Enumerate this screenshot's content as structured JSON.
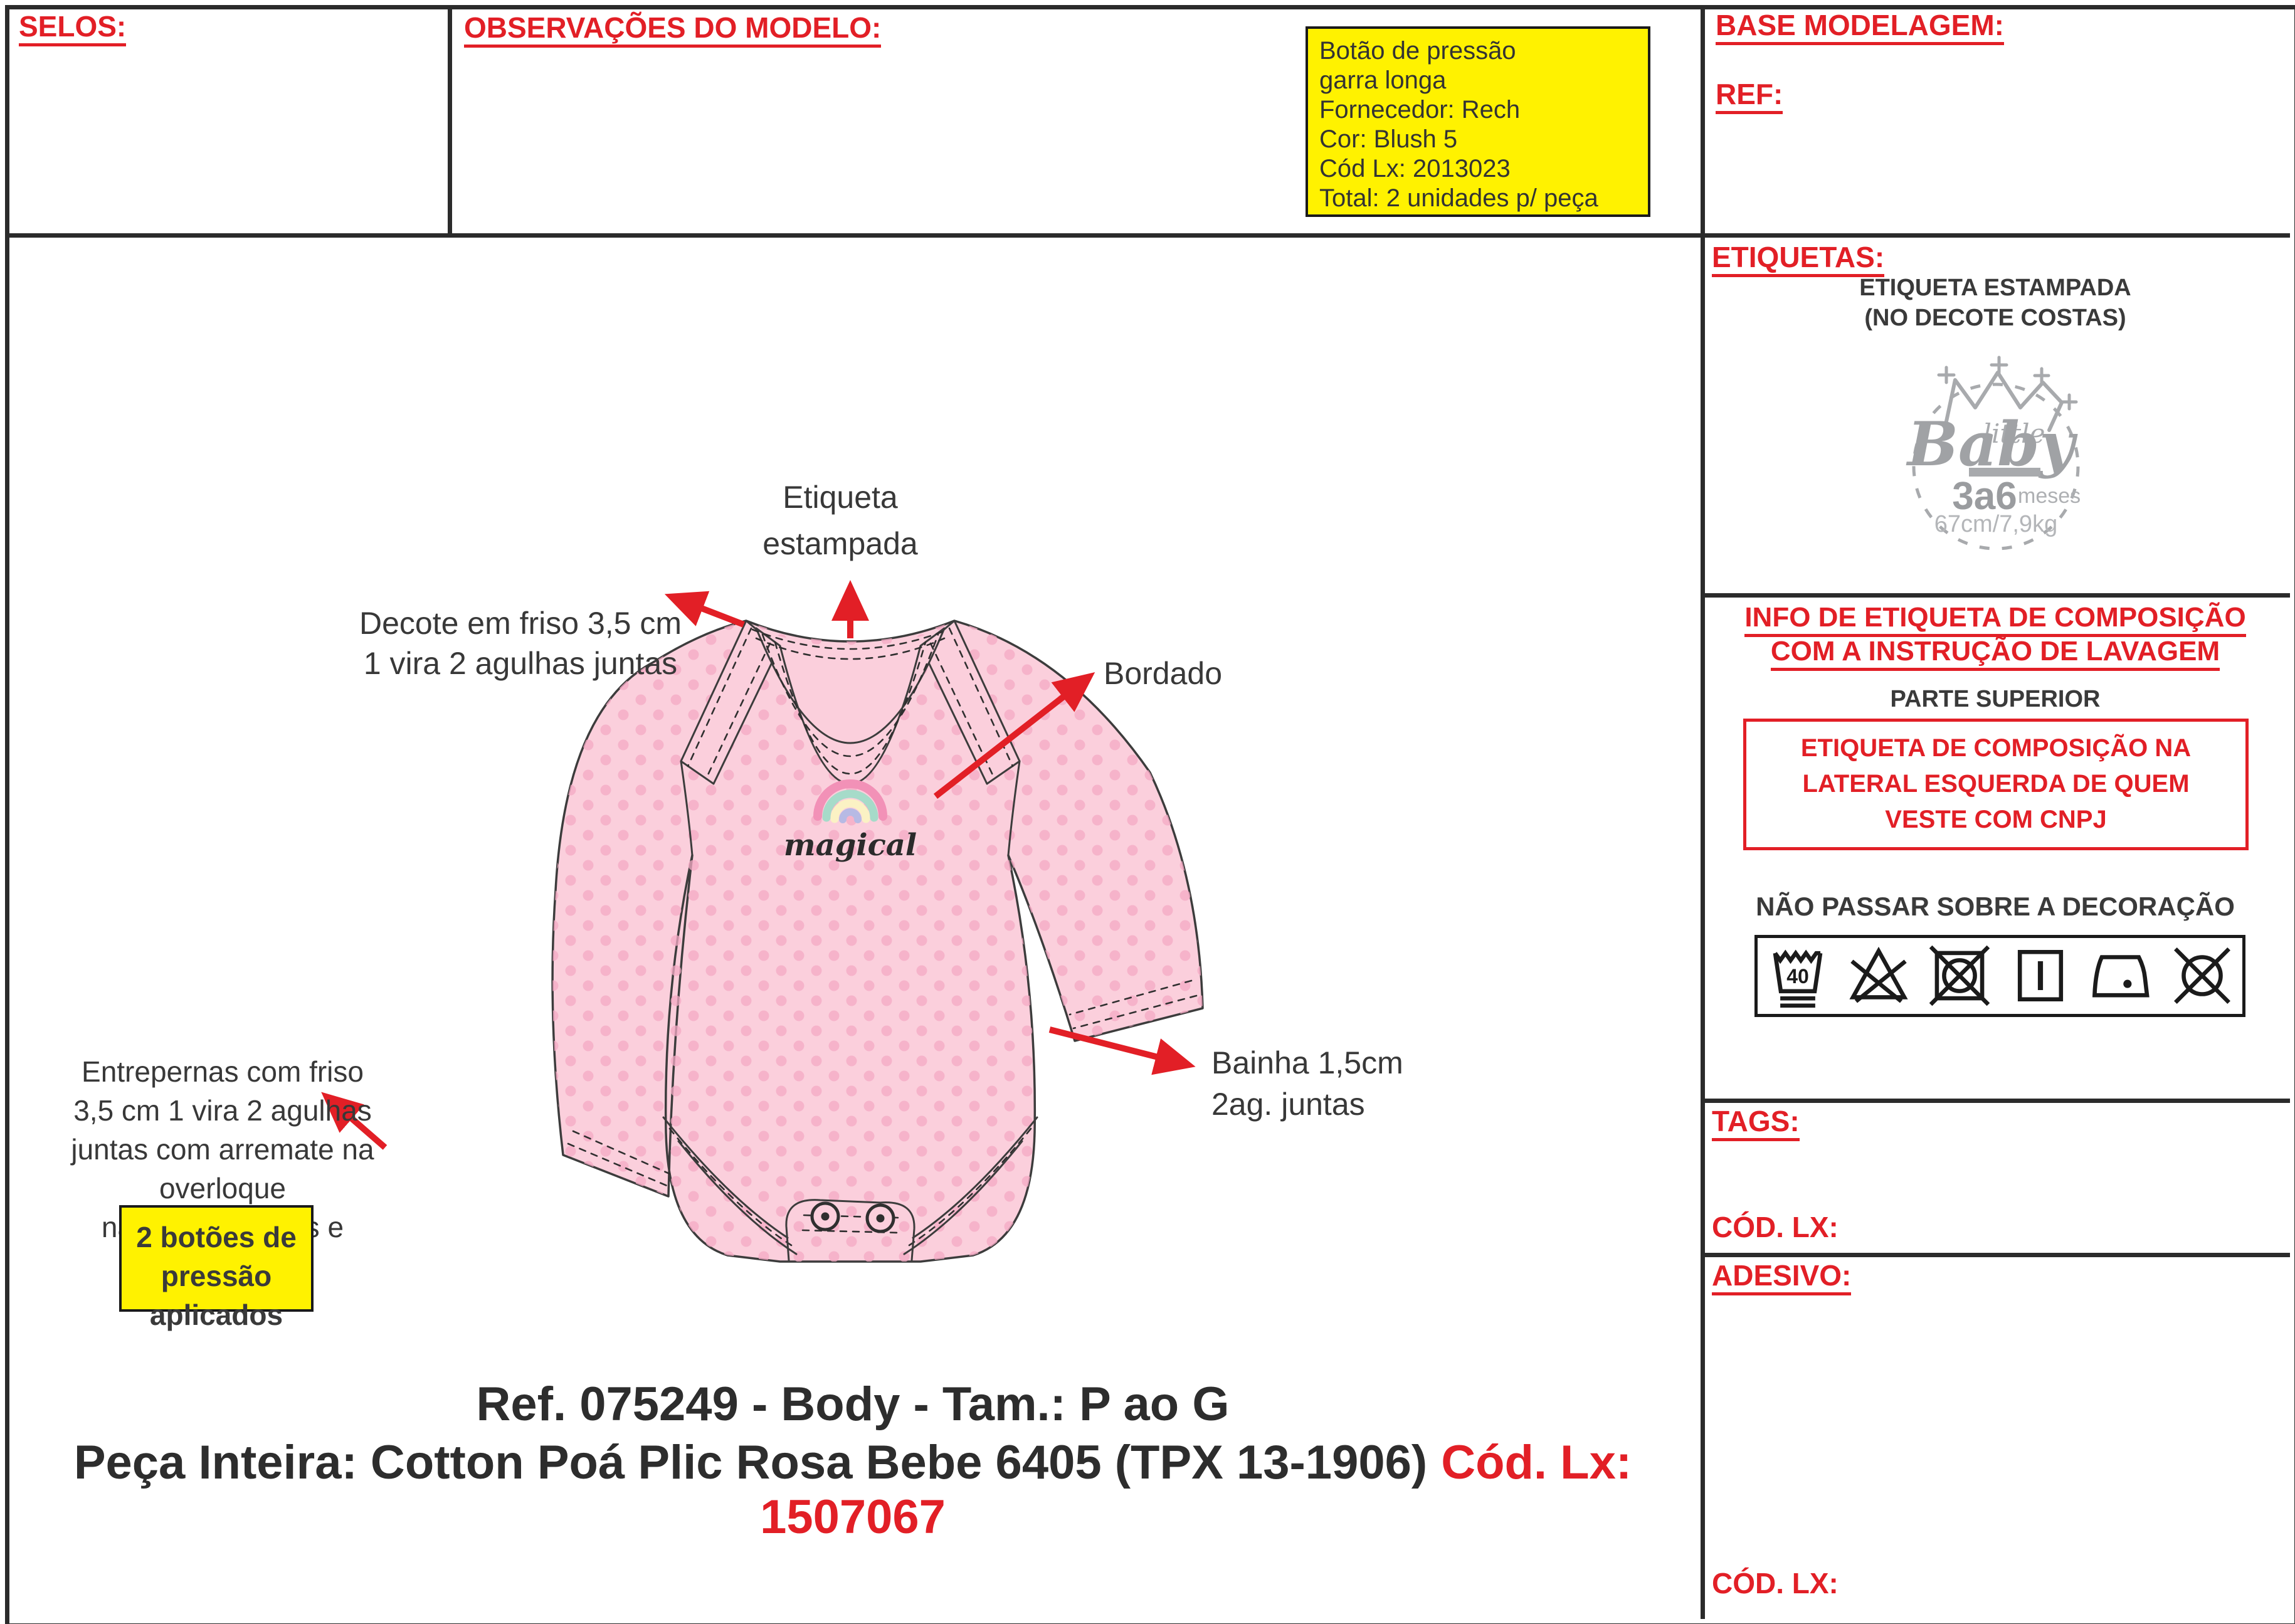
{
  "panels": {
    "selos": {
      "title": "SELOS:"
    },
    "observacoes": {
      "title": "OBSERVAÇÕES DO MODELO:",
      "note_lines": [
        "Botão de pressão",
        "garra longa",
        "Fornecedor: Rech",
        "Cor: Blush 5",
        "Cód Lx: 2013023",
        "Total: 2 unidades p/ peça"
      ]
    },
    "base": {
      "title": "BASE MODELAGEM:",
      "ref_label": "REF:"
    },
    "etiquetas": {
      "title": "ETIQUETAS:",
      "sub1": "ETIQUETA ESTAMPADA",
      "sub2": "(NO DECOTE COSTAS)",
      "logo": {
        "little": "little",
        "baby": "Baby",
        "size": "3a6",
        "size_unit": "meses",
        "measures": "67cm/7,9kg"
      }
    },
    "info": {
      "title1": "INFO DE ETIQUETA DE COMPOSIÇÃO",
      "title2": "COM A INSTRUÇÃO DE LAVAGEM",
      "parte": "PARTE SUPERIOR",
      "box_lines": [
        "ETIQUETA DE COMPOSIÇÃO NA",
        "LATERAL ESQUERDA DE QUEM",
        "VESTE COM CNPJ"
      ],
      "care_title": "NÃO PASSAR SOBRE A DECORAÇÃO",
      "wash_temp": "40"
    },
    "tags": {
      "title": "TAGS:",
      "cod_label": "CÓD. LX:"
    },
    "adesivo": {
      "title": "ADESIVO:",
      "cod_label": "CÓD. LX:"
    }
  },
  "annotations": {
    "decote": [
      "Decote em friso 3,5 cm",
      "1 vira 2 agulhas juntas"
    ],
    "etiqueta": [
      "Etiqueta",
      "estampada"
    ],
    "bordado": "Bordado",
    "bainha": [
      "Bainha 1,5cm",
      "2ag. juntas"
    ],
    "entrepernas": [
      "Entrepernas com friso",
      "3,5 cm 1 vira 2 agulhas",
      "juntas com arremate na overloque",
      "nas duas laterais e"
    ],
    "botoes": [
      "2 botões de",
      "pressão aplicados"
    ]
  },
  "artwork": {
    "word": "magical"
  },
  "footer": {
    "line1": "Ref. 075249 - Body - Tam.: P ao G",
    "line2_black": "Peça Inteira: Cotton Poá Plic Rosa Bebe 6405 (TPX 13-1906)",
    "line2_red": "Cód. Lx: 1507067"
  },
  "colors": {
    "accent_red": "#e21f26",
    "note_yellow": "#fff200",
    "body_pink": "#fbcfdc",
    "dot_pink": "#f4a9c4",
    "outline": "#3c3c3c",
    "logo_gray": "#a3a5a8"
  }
}
